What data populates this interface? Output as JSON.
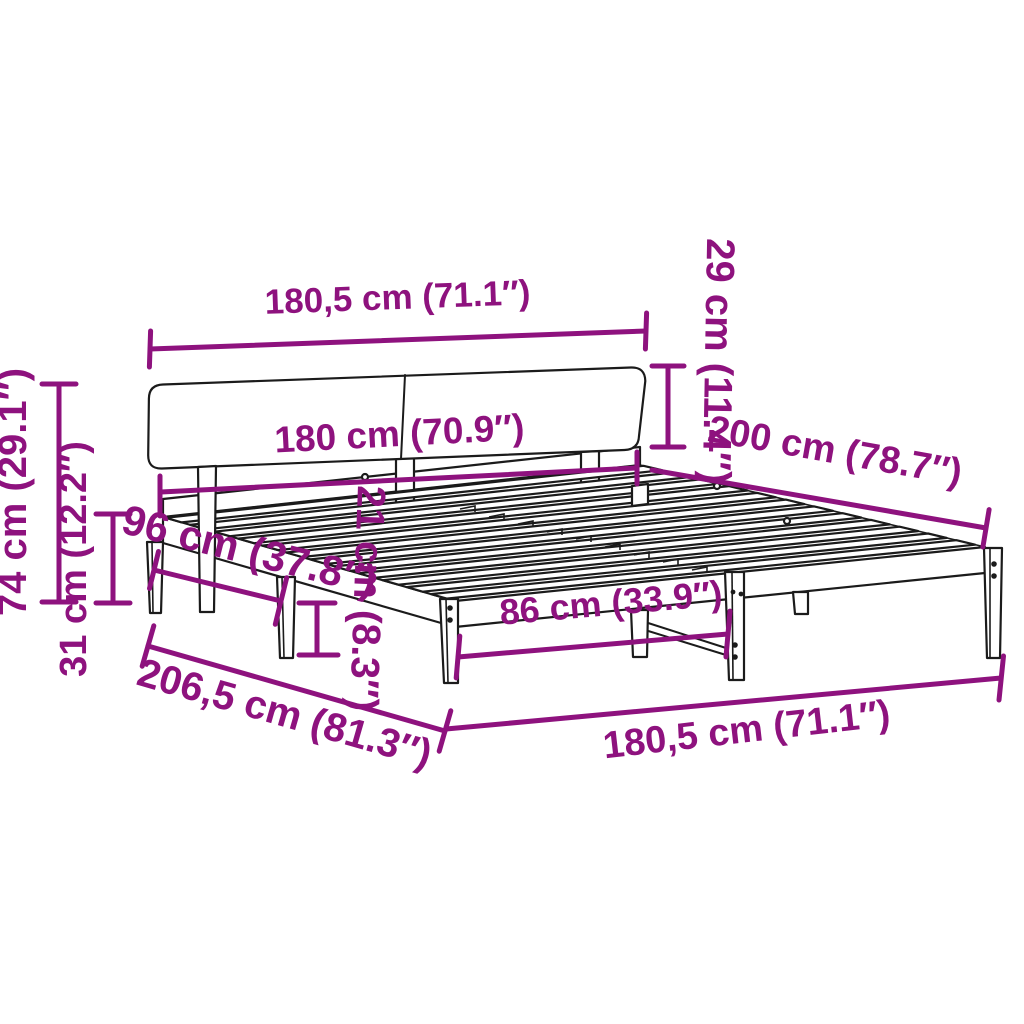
{
  "diagram": {
    "type": "product-dimension-diagram",
    "subject": "bed frame with headboard and slats",
    "colors": {
      "dimension": "#8E127E",
      "outline": "#1B1B1B",
      "background": "#FFFFFF"
    },
    "dimensions": {
      "headboard_width": "180,5 cm (71.1″)",
      "headboard_panel_height": "29 cm (11.4″)",
      "bed_width": "180 cm (70.9″)",
      "bed_length": "200 cm (78.7″)",
      "headboard_total_height": "74 cm (29.1″)",
      "frame_top_height": "31 cm (12.2″)",
      "side_leg_spacing": "96 cm (37.8″)",
      "underbed_clearance": "21 cm (8.3″)",
      "front_leg_spacing": "86 cm (33.9″)",
      "total_length": "206,5 cm (81.3″)",
      "frame_width": "180,5 cm (71.1″)"
    }
  }
}
